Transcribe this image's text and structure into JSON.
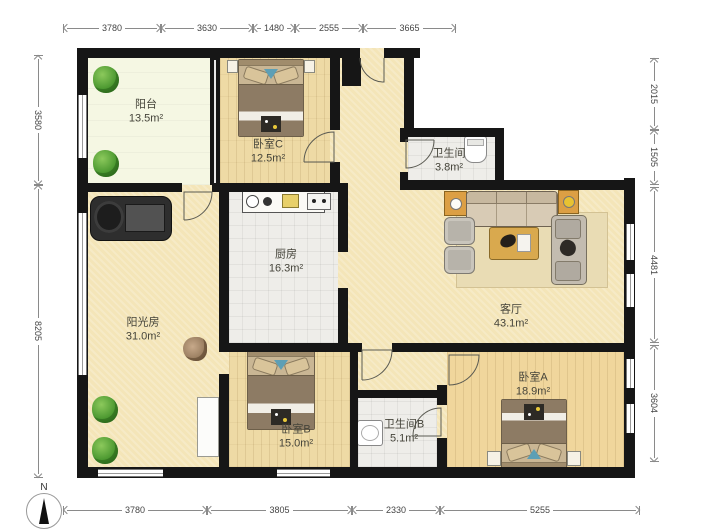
{
  "title": "apartment-floor-plan",
  "rooms": [
    {
      "id": "balcony",
      "name": "阳台",
      "area": "13.5m²"
    },
    {
      "id": "bedroom-c",
      "name": "卧室C",
      "area": "12.5m²"
    },
    {
      "id": "bathroom",
      "name": "卫生间",
      "area": "3.8m²"
    },
    {
      "id": "kitchen",
      "name": "厨房",
      "area": "16.3m²"
    },
    {
      "id": "sunroom",
      "name": "阳光房",
      "area": "31.0m²"
    },
    {
      "id": "living-room",
      "name": "客厅",
      "area": "43.1m²"
    },
    {
      "id": "bedroom-b",
      "name": "卧室B",
      "area": "15.0m²"
    },
    {
      "id": "bathroom-b",
      "name": "卫生间B",
      "area": "5.1m²"
    },
    {
      "id": "bedroom-a",
      "name": "卧室A",
      "area": "18.9m²"
    }
  ],
  "dimensions": {
    "top": [
      "3780",
      "3630",
      "1480",
      "2555",
      "3665"
    ],
    "bottom": [
      "3780",
      "3805",
      "2330",
      "5255"
    ],
    "left": [
      "3580",
      "8205"
    ],
    "right": [
      "2015",
      "1505",
      "4481",
      "3604"
    ]
  },
  "compass": {
    "label": "N"
  },
  "icons": {
    "double-bed-icon": "css-shape",
    "sofa-icon": "css-shape",
    "armchair-icon": "css-shape",
    "coffee-table-icon": "css-shape",
    "side-table-icon": "css-shape",
    "lamp-icon": "css-circle",
    "rug-icon": "css-rect",
    "plant-icon": "css-blob",
    "treadmill-icon": "css-shape",
    "kitchen-counter-icon": "css-shape",
    "toilet-icon": "css-shape",
    "washbasin-icon": "css-shape",
    "wardrobe-icon": "css-rect",
    "door-arc-icon": "svg-arc",
    "window-icon": "css-lines",
    "north-compass-icon": "css-triangle"
  },
  "colors": {
    "wall": "#161616",
    "wood_floor": "#eedaa5",
    "beige_floor": "#f4e5b8",
    "balcony_floor": "#f5f7e3",
    "tile_floor": "#eeede9",
    "furniture_wood": "#d9a94e",
    "plant_green": "#4e9a32",
    "accent_blue": "#5d9fb5"
  }
}
